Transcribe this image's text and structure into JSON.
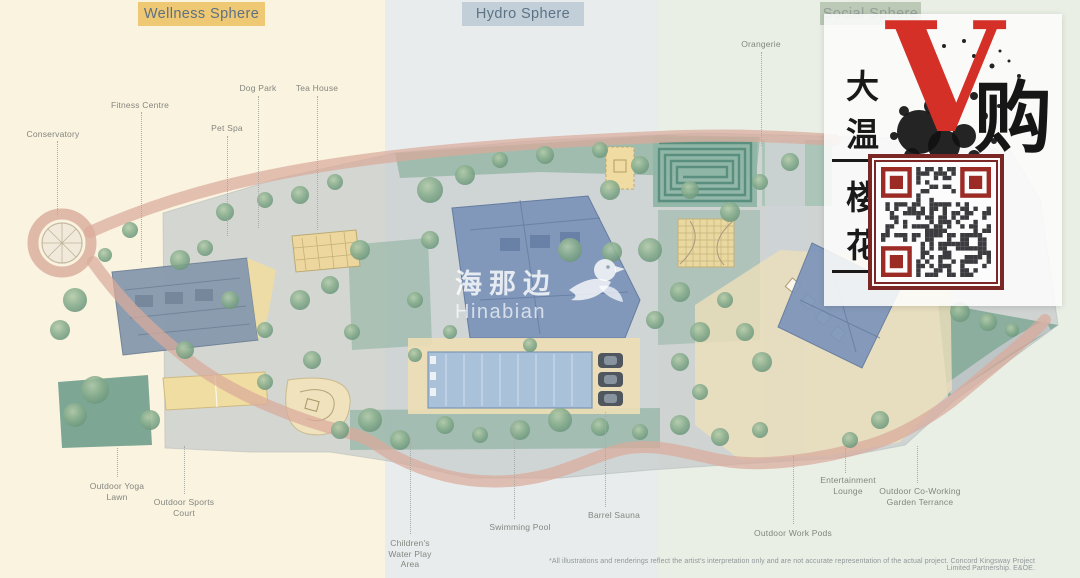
{
  "zones": [
    {
      "label": "Wellness Sphere",
      "color": "#efc873"
    },
    {
      "label": "Hydro Sphere",
      "color": "#c2ced8"
    },
    {
      "label": "Social Sphere",
      "color": "#bcc9b6"
    }
  ],
  "map_labels": [
    {
      "id": "conservatory",
      "text": "Conservatory"
    },
    {
      "id": "fitness-centre",
      "text": "Fitness Centre"
    },
    {
      "id": "dog-park",
      "text": "Dog Park"
    },
    {
      "id": "pet-spa",
      "text": "Pet Spa"
    },
    {
      "id": "tea-house",
      "text": "Tea House"
    },
    {
      "id": "orangerie",
      "text": "Orangerie"
    },
    {
      "id": "outdoor-yoga-lawn",
      "text": "Outdoor Yoga Lawn"
    },
    {
      "id": "outdoor-sports-court",
      "text": "Outdoor Sports Court"
    },
    {
      "id": "childrens-water-play-area",
      "text": "Children's Water Play Area"
    },
    {
      "id": "swimming-pool",
      "text": "Swimming Pool"
    },
    {
      "id": "barrel-sauna",
      "text": "Barrel Sauna"
    },
    {
      "id": "entertainment-lounge",
      "text": "Entertainment Lounge"
    },
    {
      "id": "outdoor-co-working-garden-terrance",
      "text": "Outdoor Co-Working Garden Terrance"
    },
    {
      "id": "outdoor-work-pods",
      "text": "Outdoor Work Pods"
    }
  ],
  "watermark": {
    "cn": "海那边",
    "en": "Hinabian"
  },
  "promo": {
    "line1": "大温",
    "line2": "楼花",
    "big_letter": "V",
    "suffix": "购"
  },
  "disclaimer": "*All illustrations and renderings reflect the artist's interpretation only and are not accurate representation of the actual project. Concord Kingsway Project Limited Partnership. E&OE.",
  "colors": {
    "wellness_band": "#faf3e0",
    "hydro_band": "#e8eced",
    "social_band": "#e9efe5",
    "path_pink": "#d9ab9b",
    "building_blue": "#7d95ba",
    "court_yellow": "#efd89c",
    "qr_frame_red": "#7b2725",
    "v_red": "#d43028"
  }
}
